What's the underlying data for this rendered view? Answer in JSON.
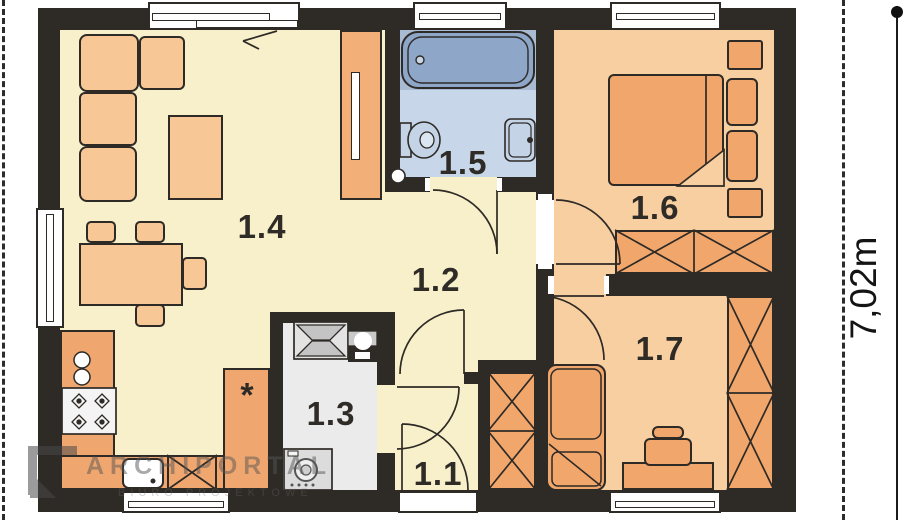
{
  "plan": {
    "rooms": [
      {
        "label": "1.1"
      },
      {
        "label": "1.2"
      },
      {
        "label": "1.3"
      },
      {
        "label": "1.4"
      },
      {
        "label": "1.5"
      },
      {
        "label": "1.6"
      },
      {
        "label": "1.7"
      }
    ],
    "dimension_right": "7,02m",
    "kitchen": {
      "fridge_symbol": "*"
    },
    "watermark": {
      "line1": "ARCHIPORTAL",
      "line2": "BIURO PROJEKTOWE"
    }
  },
  "colors": {
    "wall": "#2e2a26",
    "floor_living": "#f8f0ca",
    "floor_bedrooms": "#f7cfa1",
    "floor_bathroom": "#c7d7e9",
    "floor_utility": "#ebebeb",
    "furniture_light": "#f7c795",
    "furniture_orange": "#f1a66b",
    "counter_orange": "#f0a76f",
    "bathtub_fill": "#8ea6c8",
    "fixture_blue": "#c4d4e6"
  }
}
